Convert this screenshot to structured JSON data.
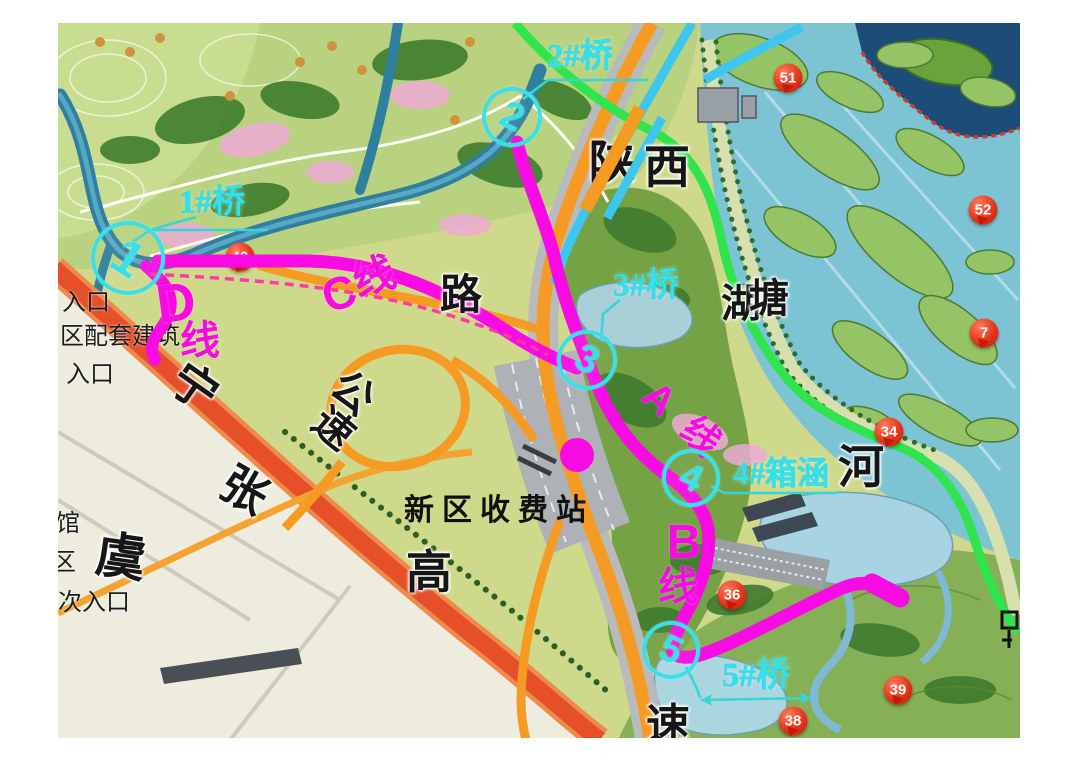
{
  "colors": {
    "route_magenta": "#f80ae2",
    "option_dashed": "#ff3aa6",
    "bridge_cyan": "#2fe2ec",
    "green_line": "#2fe44c",
    "cyan_line": "#3fc6ef",
    "orange_road": "#f59b24",
    "red_road": "#e5502b",
    "poi_red": "#d8200f",
    "field_olive": "#cfd98b",
    "wetland_water": "#7cc4d4"
  },
  "toll_station": {
    "label": "新区收费站",
    "x": 499,
    "y": 507
  },
  "route_labels": [
    {
      "t": "A",
      "x": 659,
      "y": 399,
      "s": 40,
      "r": 42
    },
    {
      "t": "线",
      "x": 700,
      "y": 437,
      "s": 38,
      "r": 42
    },
    {
      "t": "B",
      "x": 684,
      "y": 543,
      "s": 48,
      "r": 0
    },
    {
      "t": "线",
      "x": 678,
      "y": 587,
      "s": 40,
      "r": 0
    },
    {
      "t": "C",
      "x": 339,
      "y": 293,
      "s": 46,
      "r": -18
    },
    {
      "t": "线",
      "x": 374,
      "y": 277,
      "s": 42,
      "r": -18
    },
    {
      "t": "D",
      "x": 176,
      "y": 303,
      "s": 54,
      "r": -8
    },
    {
      "t": "线",
      "x": 200,
      "y": 341,
      "s": 40,
      "r": 0
    }
  ],
  "bridge_labels": [
    {
      "t": "1#桥",
      "x": 212,
      "y": 203,
      "s": 33
    },
    {
      "t": "2#桥",
      "x": 580,
      "y": 57,
      "s": 33
    },
    {
      "t": "3#桥",
      "x": 646,
      "y": 286,
      "s": 33
    },
    {
      "t": "4#箱涵",
      "x": 781,
      "y": 473,
      "s": 32
    },
    {
      "t": "5#桥",
      "x": 756,
      "y": 676,
      "s": 34
    }
  ],
  "station_points": [
    {
      "t": "1",
      "x": 128,
      "y": 258,
      "r": 33
    },
    {
      "t": "2",
      "x": 512,
      "y": 117,
      "r": 26
    },
    {
      "t": "3",
      "x": 587,
      "y": 360,
      "r": 26
    },
    {
      "t": "4",
      "x": 691,
      "y": 478,
      "r": 25
    },
    {
      "t": "5",
      "x": 671,
      "y": 650,
      "r": 25
    }
  ],
  "poi_markers": [
    {
      "t": "40",
      "x": 240,
      "y": 257
    },
    {
      "t": "51",
      "x": 788,
      "y": 78
    },
    {
      "t": "52",
      "x": 983,
      "y": 210
    },
    {
      "t": "7",
      "x": 984,
      "y": 333
    },
    {
      "t": "34",
      "x": 889,
      "y": 432
    },
    {
      "t": "36",
      "x": 732,
      "y": 595
    },
    {
      "t": "39",
      "x": 898,
      "y": 690
    },
    {
      "t": "38",
      "x": 793,
      "y": 721
    }
  ],
  "road_chars": [
    {
      "t": "宁",
      "x": 194,
      "y": 388,
      "s": 46,
      "r": 35
    },
    {
      "t": "张",
      "x": 244,
      "y": 491,
      "s": 46,
      "r": 30
    },
    {
      "t": "虞",
      "x": 121,
      "y": 557,
      "s": 50,
      "r": 8
    },
    {
      "t": "高",
      "x": 429,
      "y": 573,
      "s": 46,
      "r": 0
    },
    {
      "t": "速",
      "x": 668,
      "y": 726,
      "s": 44,
      "r": 0
    },
    {
      "t": "公",
      "x": 352,
      "y": 394,
      "s": 42,
      "r": 40
    },
    {
      "t": "速",
      "x": 333,
      "y": 429,
      "s": 40,
      "r": 40
    },
    {
      "t": "路",
      "x": 461,
      "y": 296,
      "s": 42,
      "r": 0
    }
  ],
  "water_chars": [
    {
      "t": "西",
      "x": 667,
      "y": 168,
      "s": 46,
      "r": 0
    },
    {
      "t": "湖",
      "x": 741,
      "y": 304,
      "s": 40,
      "r": 0
    },
    {
      "t": "塘",
      "x": 769,
      "y": 299,
      "s": 40,
      "r": 0
    },
    {
      "t": "河",
      "x": 861,
      "y": 468,
      "s": 46,
      "r": 0
    }
  ],
  "under_chars": [
    {
      "t": "陕",
      "x": 612,
      "y": 163,
      "s": 46,
      "r": 0
    }
  ],
  "left_labels": [
    {
      "t": "入口",
      "x": 62,
      "y": 303,
      "s": 24
    },
    {
      "t": "区配套建筑",
      "x": 60,
      "y": 337,
      "s": 24
    },
    {
      "t": "入口",
      "x": 66,
      "y": 375,
      "s": 24
    },
    {
      "t": "馆",
      "x": 56,
      "y": 524,
      "s": 24
    },
    {
      "t": "区",
      "x": 52,
      "y": 563,
      "s": 24
    },
    {
      "t": "次入口",
      "x": 58,
      "y": 603,
      "s": 24
    }
  ]
}
